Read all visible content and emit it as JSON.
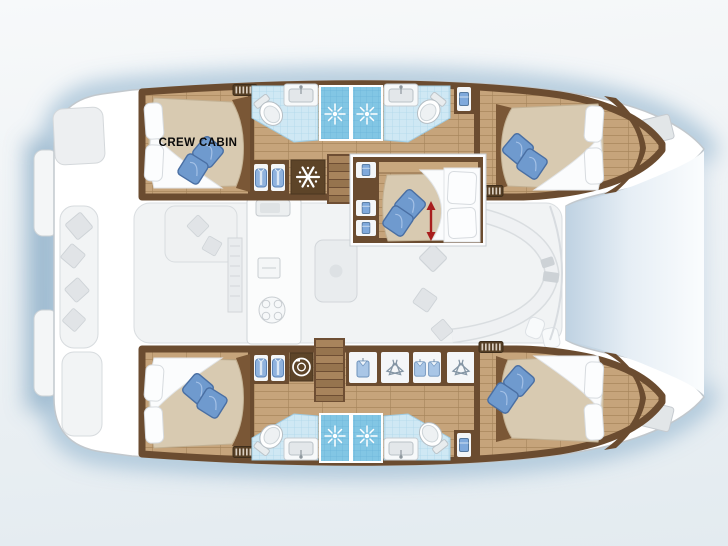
{
  "diagram": {
    "type": "catamaran-yacht-interior-deck-plan",
    "orientation": "bow-right",
    "labels": {
      "crew_cabin": "CREW CABIN"
    },
    "counts": {
      "double_berths": 5,
      "bathrooms": 4,
      "shower_stalls": 4,
      "crew_cabins": 1
    },
    "icons": {
      "shower_icon": "white sunburst spray on blue tiled shower stall",
      "snowflake_icon": "white snowflake on dark cabinet (fridge/freezer)",
      "washing_machine_icon": "white drum circle on dark cabinet",
      "hanger_icon": "clothes hangers in wardrobe",
      "shirt_icon": "hanging blue shirt in wardrobe",
      "towel_icon": "folded blue towel in locker",
      "jacket_icon": "blue jacket in locker",
      "vent_grille_icon": "slatted vent grille",
      "double_arrow_icon": "red double-headed arrow (adjustable berth)",
      "toilet_icon": "toilet bowl",
      "sink_icon": "washbasin with faucet",
      "stove_icon": "cooktop rings in ghosted galley",
      "stairs_icon": "companionway steps"
    },
    "colors": {
      "background_top": "#f6f8f9",
      "background_bottom": "#e3ebf0",
      "water_glow": "#9fbdd4",
      "hull_white": "#ffffff",
      "hull_stroke": "#c2c8cd",
      "wood_floor": "#c6a47b",
      "wood_dark_wall": "#6b4c30",
      "wood_furniture": "#7a5736",
      "bathroom_tile": "#cfe8f4",
      "shower_tile": "#82c6e4",
      "mattress_beige": "#d8cab1",
      "bedding_white": "#fbfcfd",
      "pillow_blue": "#6f9ace",
      "ghost_gray": "#eff1f3",
      "ghost_stroke": "#d6dade",
      "arrow_red": "#a81e1e",
      "label_text": "#0a0a0a"
    }
  }
}
